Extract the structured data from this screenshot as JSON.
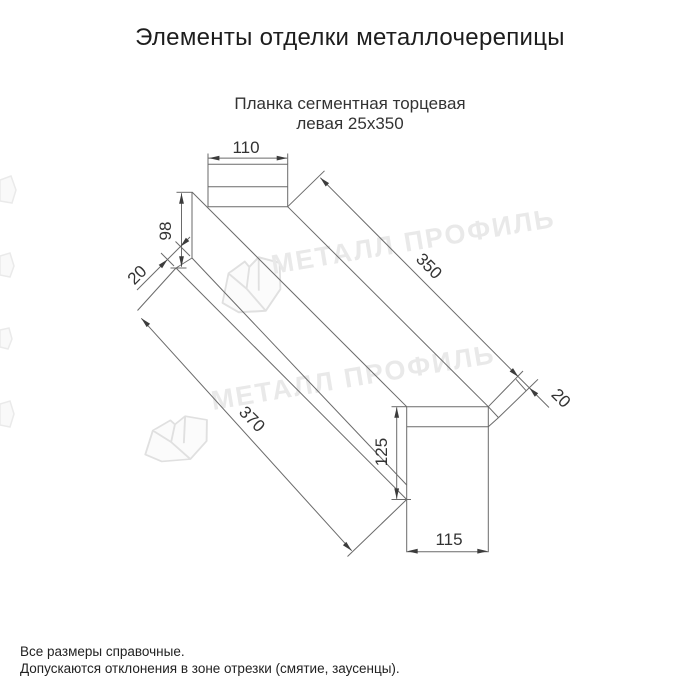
{
  "page": {
    "title": "Элементы отделки металлочерепицы",
    "subtitle_line1": "Планка сегментная торцевая",
    "subtitle_line2": "левая 25х350",
    "footnote_line1": "Все размеры справочные.",
    "footnote_line2": "Допускаются отклонения в зоне отрезки (смятие, заусенцы)."
  },
  "drawing": {
    "part_name": "Планка сегментная торцевая левая 25х350",
    "watermark_text": "МЕТАЛЛ ПРОФИЛЬ",
    "dims": {
      "flange_top_width": "110",
      "side_height": "98",
      "side_fold": "20",
      "length_top": "350",
      "end_fold": "20",
      "length_bottom": "370",
      "flange_bottom_height": "125",
      "flange_bottom_width": "115"
    },
    "colors": {
      "line": "#6a6a6a",
      "dim_text": "#333333",
      "watermark": "#e9e9e9"
    }
  }
}
